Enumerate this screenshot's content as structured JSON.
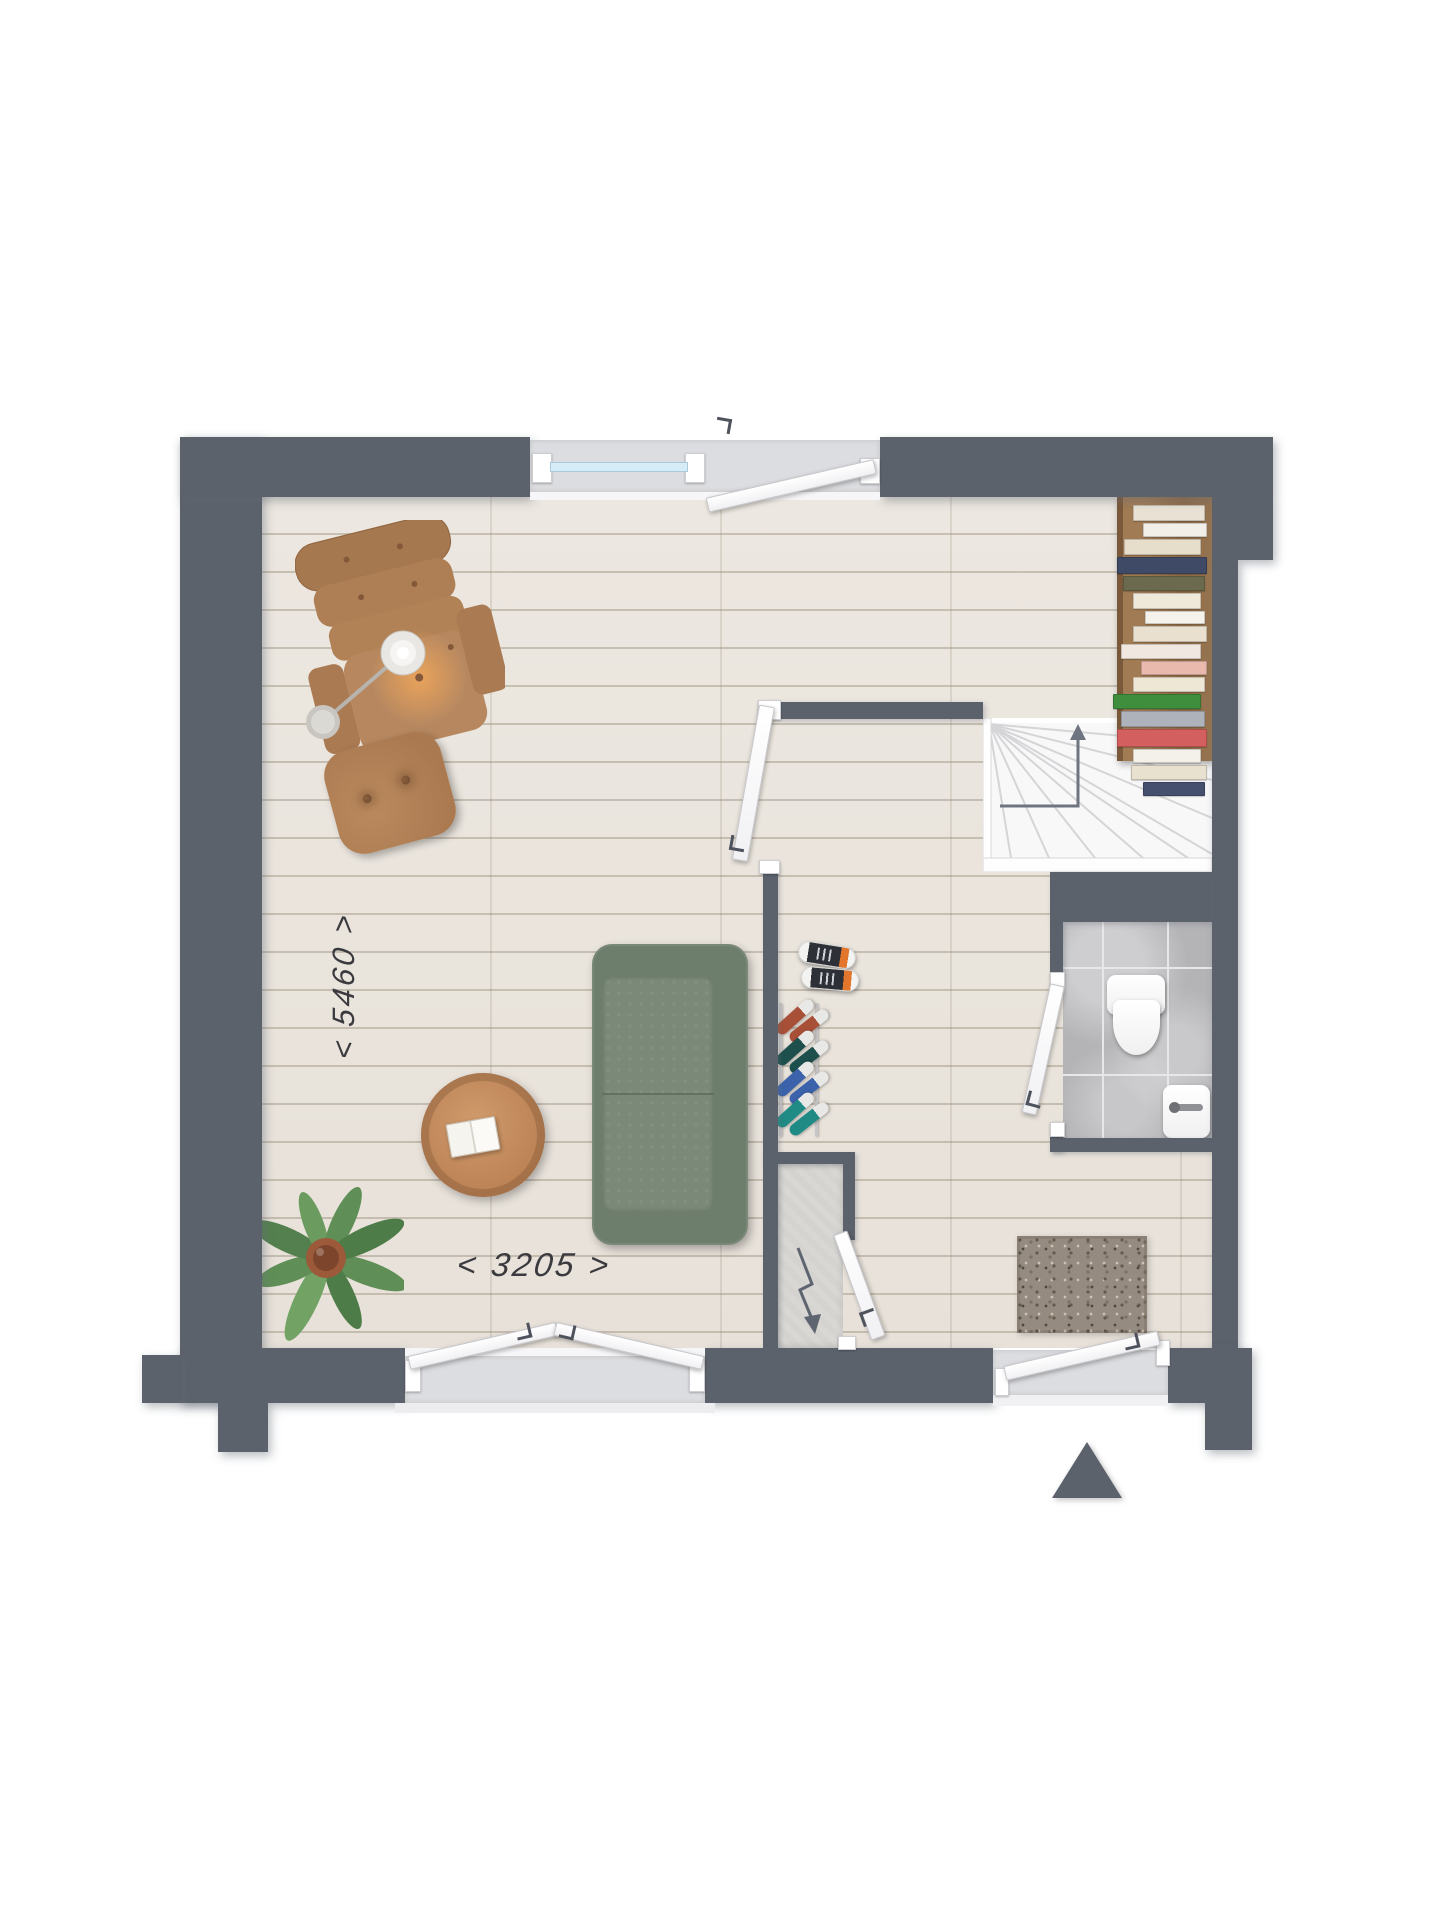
{
  "page": {
    "type": "floor-plan",
    "background": "#ffffff"
  },
  "labels": {
    "dimension_vertical": "< 5460 >",
    "dimension_horizontal": "< 3205 >"
  },
  "icons": {
    "stairs_up_arrow": "up-arrow",
    "electric_meter_bolt": "lightning-bolt",
    "entrance_arrow": "triangle-up"
  },
  "palette": {
    "wall": "#5c626c",
    "floor": "#ebe6df",
    "floor_line": "#d6cfc5",
    "opening_bay": "#dcdde0",
    "window_glass": "#d6ecf6",
    "stairs": "#f8f8f9",
    "tile": "#b4b4b7",
    "shelf_wood": "#9a744e",
    "sofa_green": "#6e7e6d",
    "leather_tan": "#b28257",
    "table_wood": "#c38e61",
    "plant_green": "#5f8f56",
    "doormat": "#968b80",
    "concrete": "#d8d7d4",
    "dimension_text": "#3a3a3f"
  },
  "bookshelf": {
    "books": [
      {
        "color": "#e9e2d4",
        "width": 70,
        "height": 14
      },
      {
        "color": "#f2efe8",
        "width": 62,
        "height": 12
      },
      {
        "color": "#e6ddcb",
        "width": 75,
        "height": 14
      },
      {
        "color": "#3f4a66",
        "width": 88,
        "height": 15
      },
      {
        "color": "#6b6a4e",
        "width": 80,
        "height": 13
      },
      {
        "color": "#efe9da",
        "width": 66,
        "height": 14
      },
      {
        "color": "#f5f2ec",
        "width": 58,
        "height": 11
      },
      {
        "color": "#e9e0cf",
        "width": 72,
        "height": 14
      },
      {
        "color": "#f0e8e0",
        "width": 78,
        "height": 13
      },
      {
        "color": "#e8b9ac",
        "width": 64,
        "height": 12
      },
      {
        "color": "#efe7d6",
        "width": 70,
        "height": 13
      },
      {
        "color": "#3e8e3e",
        "width": 86,
        "height": 13
      },
      {
        "color": "#aeb2bb",
        "width": 82,
        "height": 14
      },
      {
        "color": "#d35f5f",
        "width": 88,
        "height": 16
      },
      {
        "color": "#f4f1ea",
        "width": 66,
        "height": 12
      },
      {
        "color": "#e9e1d0",
        "width": 74,
        "height": 13
      },
      {
        "color": "#454f6e",
        "width": 60,
        "height": 12
      }
    ]
  },
  "shoe_rack": {
    "shoes": [
      "#a84f37",
      "#1d4f4c",
      "#3b62aa",
      "#208a84"
    ]
  }
}
